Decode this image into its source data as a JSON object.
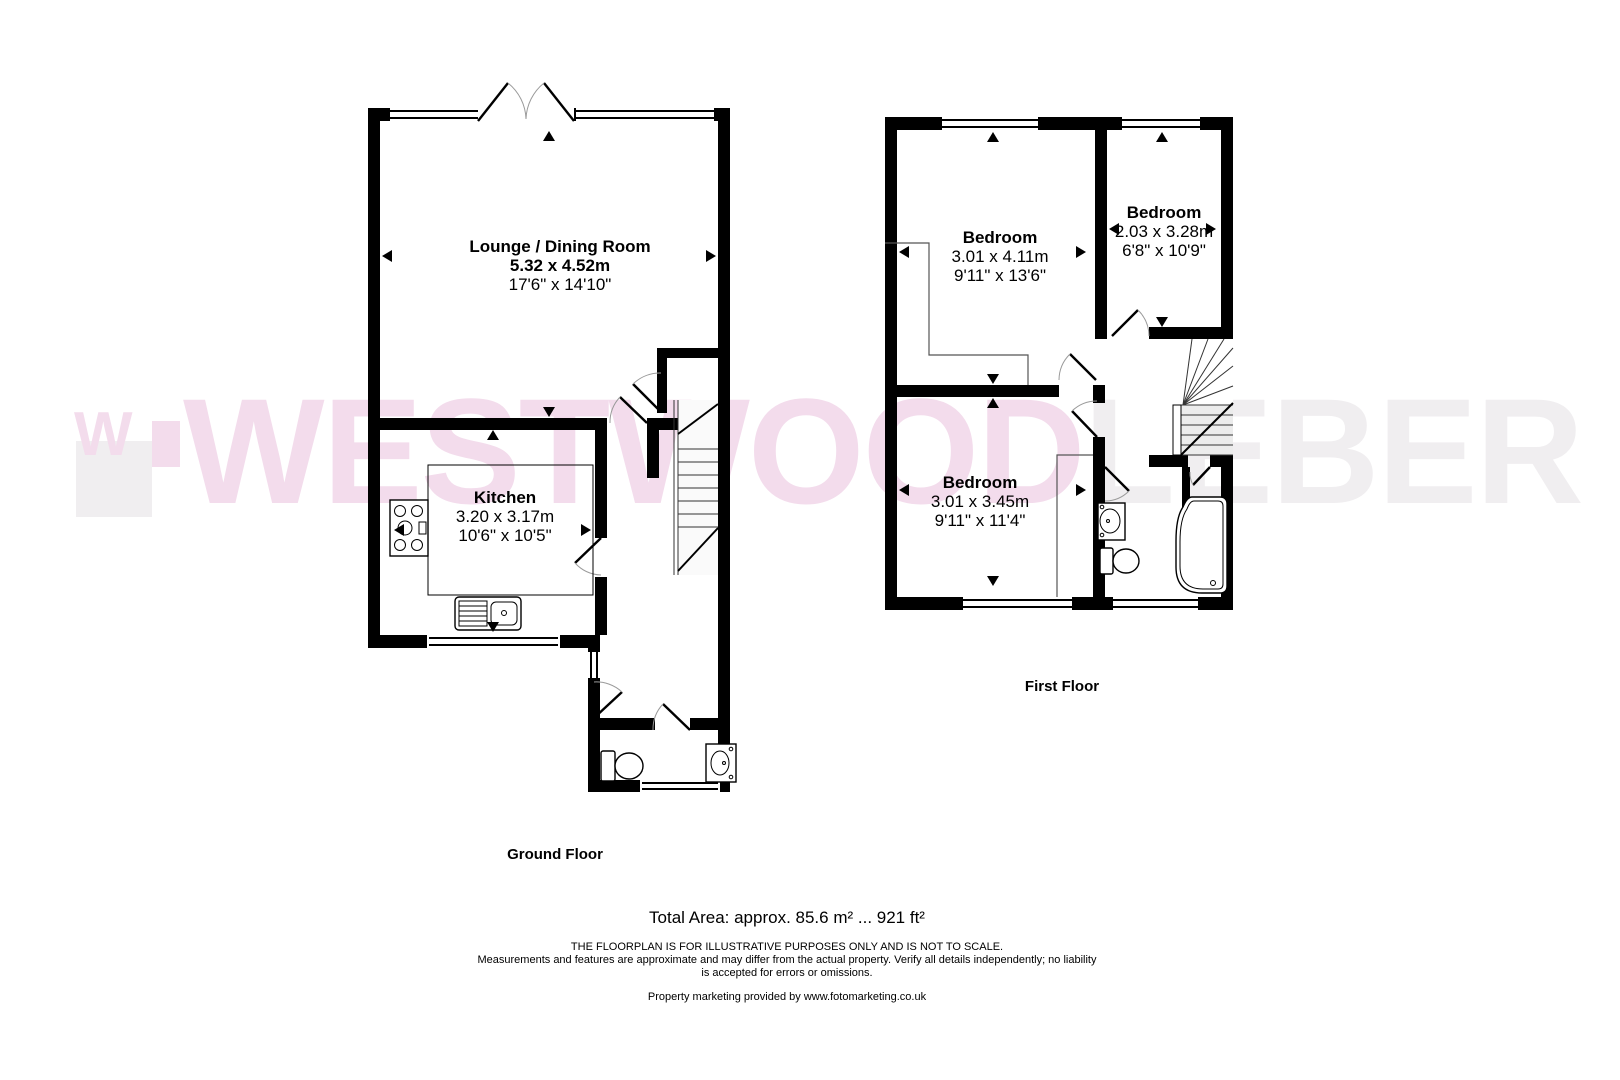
{
  "watermark": {
    "brand_part1": "WESTWOOD",
    "brand_part2": "LEBER",
    "logo_monogram": "W",
    "pink": "#f3dcec",
    "gray": "#f0eef0"
  },
  "ground_floor": {
    "label": "Ground Floor",
    "rooms": {
      "lounge": {
        "name": "Lounge / Dining Room",
        "metric": "5.32 x 4.52m",
        "imperial": "17'6\" x 14'10\""
      },
      "kitchen": {
        "name": "Kitchen",
        "metric": "3.20 x 3.17m",
        "imperial": "10'6\" x 10'5\""
      }
    }
  },
  "first_floor": {
    "label": "First Floor",
    "rooms": {
      "bedroom1": {
        "name": "Bedroom",
        "metric": "3.01 x 4.11m",
        "imperial": "9'11\" x 13'6\""
      },
      "bedroom2": {
        "name": "Bedroom",
        "metric": "2.03 x 3.28m",
        "imperial": "6'8\" x 10'9\""
      },
      "bedroom3": {
        "name": "Bedroom",
        "metric": "3.01 x 3.45m",
        "imperial": "9'11\" x 11'4\""
      }
    }
  },
  "footer": {
    "total_area": "Total Area: approx. 85.6 m² ... 921 ft²",
    "disclaimer_line1": "THE FLOORPLAN IS FOR ILLUSTRATIVE PURPOSES ONLY AND IS NOT TO SCALE.",
    "disclaimer_line2": "Measurements and features are approximate and may differ from the actual property. Verify all details independently; no liability",
    "disclaimer_line3": "is accepted for errors or omissions.",
    "credit": "Property marketing provided by www.fotomarketing.co.uk"
  }
}
